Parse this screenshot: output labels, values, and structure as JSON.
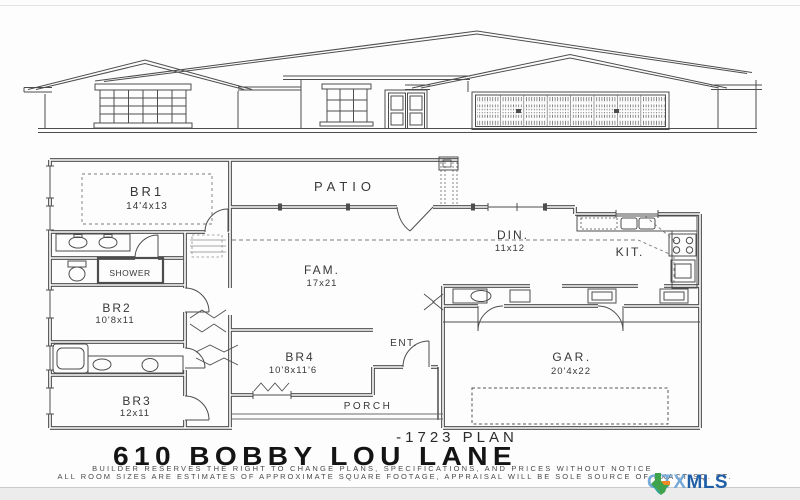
{
  "document": {
    "plan_label": "-1723 PLAN",
    "address_title": "610 BOBBY LOU LANE",
    "disclaimer_line1": "BUILDER RESERVES THE RIGHT TO CHANGE PLANS, SPECIFICATIONS, AND PRICES WITHOUT NOTICE",
    "disclaimer_line2": "ALL ROOM SIZES ARE ESTIMATES OF APPROXIMATE SQUARE FOOTAGE, APPRAISAL WILL BE SOLE SOURCE OF EXACT SQ. FT."
  },
  "floor_plan": {
    "rooms": [
      {
        "name": "BR1",
        "dim": "14'4x13"
      },
      {
        "name": "PATIO",
        "dim": ""
      },
      {
        "name": "DIN.",
        "dim": "11x12"
      },
      {
        "name": "KIT.",
        "dim": ""
      },
      {
        "name": "FAM.",
        "dim": "17x21"
      },
      {
        "name": "SHOWER",
        "dim": ""
      },
      {
        "name": "BR2",
        "dim": "10'8x11"
      },
      {
        "name": "BR4",
        "dim": "10'8x11'6"
      },
      {
        "name": "ENT.",
        "dim": ""
      },
      {
        "name": "GAR.",
        "dim": "20'4x22"
      },
      {
        "name": "BR3",
        "dim": "12x11"
      },
      {
        "name": "PORCH",
        "dim": ""
      }
    ]
  },
  "branding": {
    "logo_ctx": "CTX",
    "logo_mls": "MLS",
    "colors": {
      "ctx_blue": "#74a9d8",
      "mls_blue": "#2160a8",
      "texas_green": "#3fa24c",
      "texas_teal": "#2aa198",
      "texas_orange": "#f08a24"
    }
  },
  "drawing": {
    "line_color": "#4d4d4d",
    "background": "#fdfdfd"
  }
}
